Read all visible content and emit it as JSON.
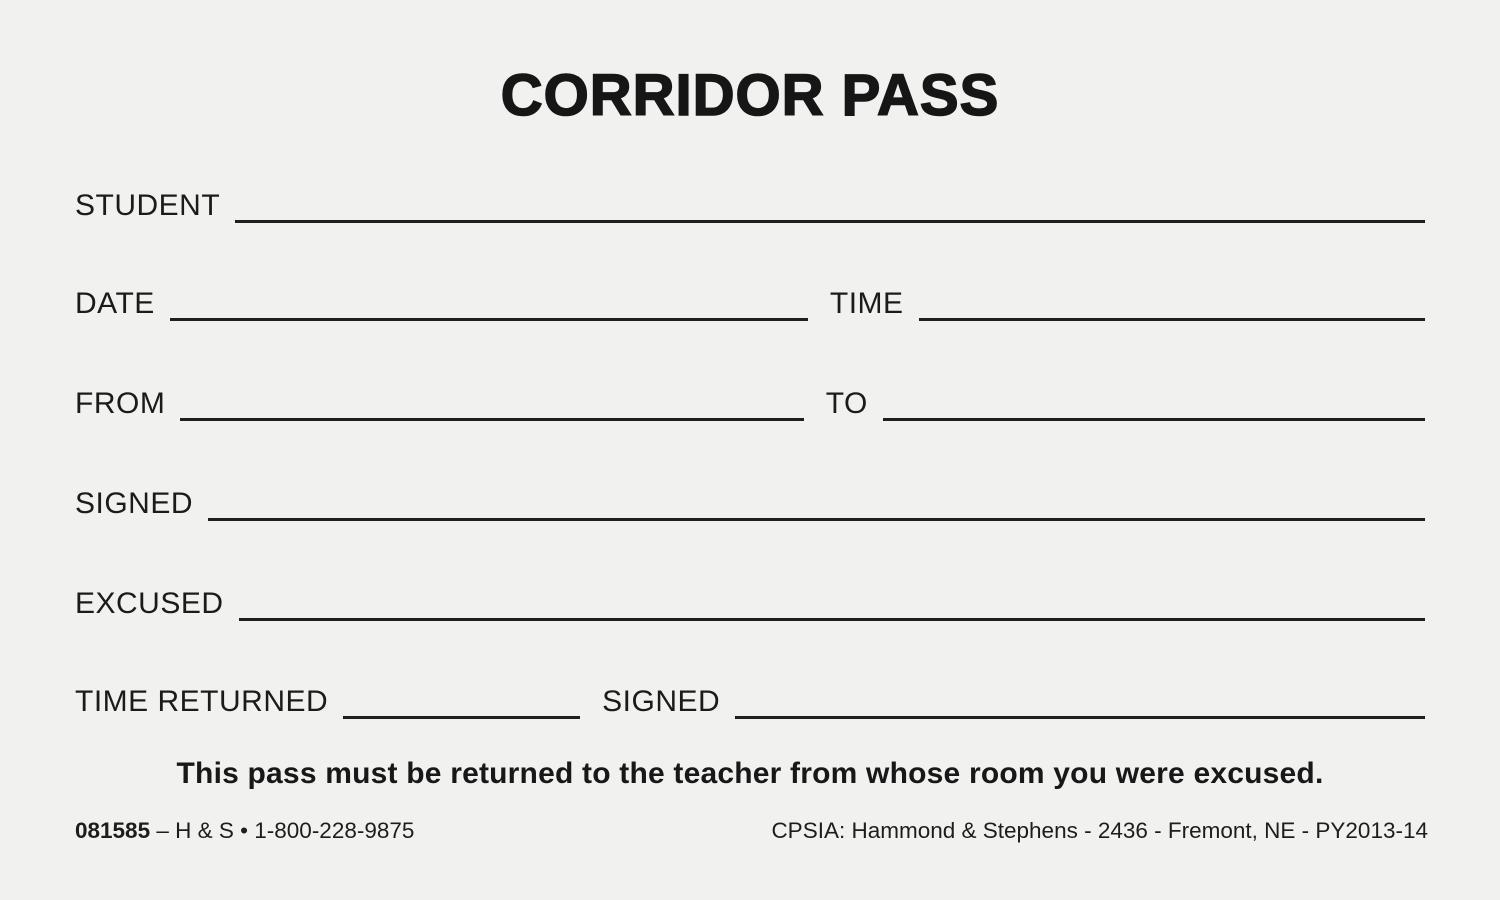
{
  "title": "CORRIDOR PASS",
  "form": {
    "student_label": "STUDENT",
    "student_value": "",
    "date_label": "DATE",
    "date_value": "",
    "time_label": "TIME",
    "time_value": "",
    "from_label": "FROM",
    "from_value": "",
    "to_label": "TO",
    "to_value": "",
    "signed_label": "SIGNED",
    "signed_value": "",
    "excused_label": "EXCUSED",
    "excused_value": "",
    "time_returned_label": "TIME RETURNED",
    "time_returned_value": "",
    "signed_return_label": "SIGNED",
    "signed_return_value": ""
  },
  "note": "This pass must be returned to the teacher from whose room you were excused.",
  "footer": {
    "form_number": "081585",
    "left_text": "– H & S • 1-800-228-9875",
    "right_text": "CPSIA: Hammond & Stephens - 2436 - Fremont, NE - PY2013-14"
  },
  "colors": {
    "paper": "#f1f1ef",
    "ink": "#1b1b1b"
  }
}
